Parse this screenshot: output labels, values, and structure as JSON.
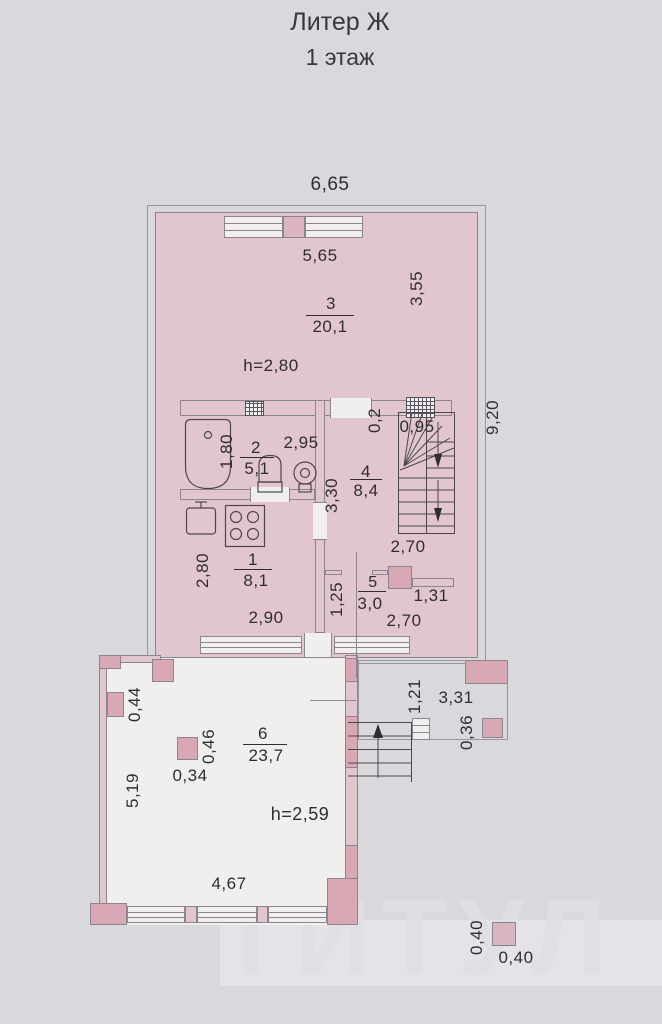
{
  "title": {
    "building": "Литер Ж",
    "floor": "1 этаж"
  },
  "rooms": {
    "r1": {
      "number": "1",
      "area": "8,1"
    },
    "r2": {
      "number": "2",
      "area": "5,1"
    },
    "r3": {
      "number": "3",
      "area": "20,1"
    },
    "r4": {
      "number": "4",
      "area": "8,4"
    },
    "r5": {
      "number": "5",
      "area": "3,0"
    },
    "r6": {
      "number": "6",
      "area": "23,7"
    }
  },
  "heights": {
    "main_floor": "h=2,80",
    "veranda": "h=2,59"
  },
  "dims": {
    "top_width": "6,65",
    "room3_width": "5,65",
    "room3_depth": "3,55",
    "right_height": "9,20",
    "room2_depth": "1,80",
    "room2_width": "2,95",
    "wall_stub": "0,2",
    "stair_width": "0,95",
    "room4_depth": "3,30",
    "room4_width": "2,70",
    "room1_depth": "2,80",
    "room1_width": "2,90",
    "room5_depth": "1,25",
    "room5_right": "1,31",
    "room5_width": "2,70",
    "porch_depth": "1,21",
    "porch_width": "3,31",
    "porch_pillar": "0,36",
    "wall_pier": "0,44",
    "pillar_depth": "0,46",
    "pillar_width": "0,34",
    "veranda_depth": "5,19",
    "veranda_width": "4,67",
    "post_depth": "0,40",
    "post_width": "0,40"
  },
  "watermark": "ТИТУЛ",
  "colors": {
    "paper": "#d9d8dc",
    "room": "#f0efee",
    "wall": "#e2c6ce",
    "pier": "#d8a8b5",
    "line": "#8b8591",
    "ink": "#2f2d33"
  }
}
